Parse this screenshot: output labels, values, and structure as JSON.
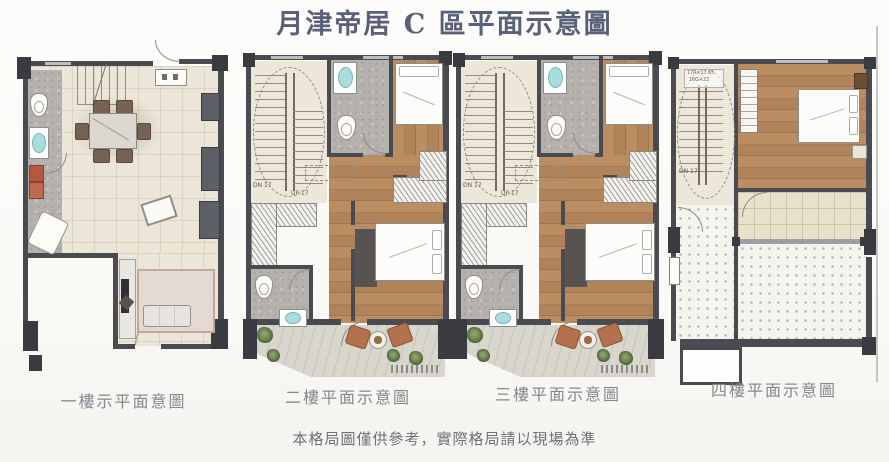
{
  "sheet": {
    "title": "月津帝居 C 區平面示意圖",
    "disclaimer": "本格局圖僅供參考，實際格局請以現場為準"
  },
  "plans": [
    {
      "label": "一樓示平面意圖"
    },
    {
      "label": "二樓平面示意圖",
      "stair_down": "DN 17",
      "stair_up": "UP 17"
    },
    {
      "label": "三樓平面示意圖",
      "stair_down": "DN 17",
      "stair_up": "UP 17"
    },
    {
      "label": "四樓平面示意圖",
      "stair_down": "DN 17",
      "stair_dim1": "17R×17.65",
      "stair_dim2": "16G×23"
    }
  ],
  "colors": {
    "wall": "#4a4b50",
    "column": "#3a3b40",
    "tile_floor": "#ebe6d8",
    "wood_floor": "#b1835a",
    "bath_floor": "#b5b1ac",
    "sink_basin": "#a9dcdc",
    "balcony_floor": "#d9d6ce",
    "terracotta_chair": "#b4714d",
    "plant_green": "#5c7444",
    "title_text": "#59607a",
    "label_text": "#85888f"
  }
}
